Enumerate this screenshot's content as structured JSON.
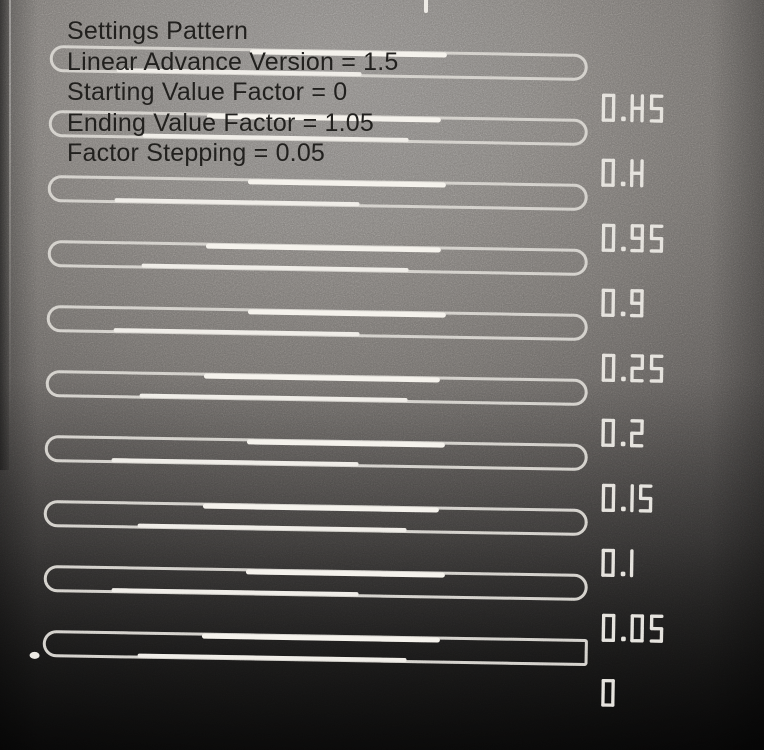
{
  "settings_text": {
    "title": "Settings Pattern",
    "lines": [
      "Linear Advance Version = 1.5",
      "Starting Value Factor = 0",
      "Ending Value Factor = 1.05",
      "Factor Stepping = 0.05"
    ]
  },
  "pattern": {
    "rows": [
      {
        "factor": "0.45"
      },
      {
        "factor": "0.4"
      },
      {
        "factor": "0.35"
      },
      {
        "factor": "0.3"
      },
      {
        "factor": "0.25"
      },
      {
        "factor": "0.2"
      },
      {
        "factor": "0.15"
      },
      {
        "factor": "0.1"
      },
      {
        "factor": "0.05"
      },
      {
        "factor": "0"
      }
    ]
  },
  "colors": {
    "printed_line": "#cfccc6",
    "printed_line_bright": "#f4f1ea",
    "label_stroke": "#e2dfd9",
    "overlay_text": "#1d1c1a",
    "bed_light": "#8d8a87",
    "bed_dark": "#141413"
  }
}
